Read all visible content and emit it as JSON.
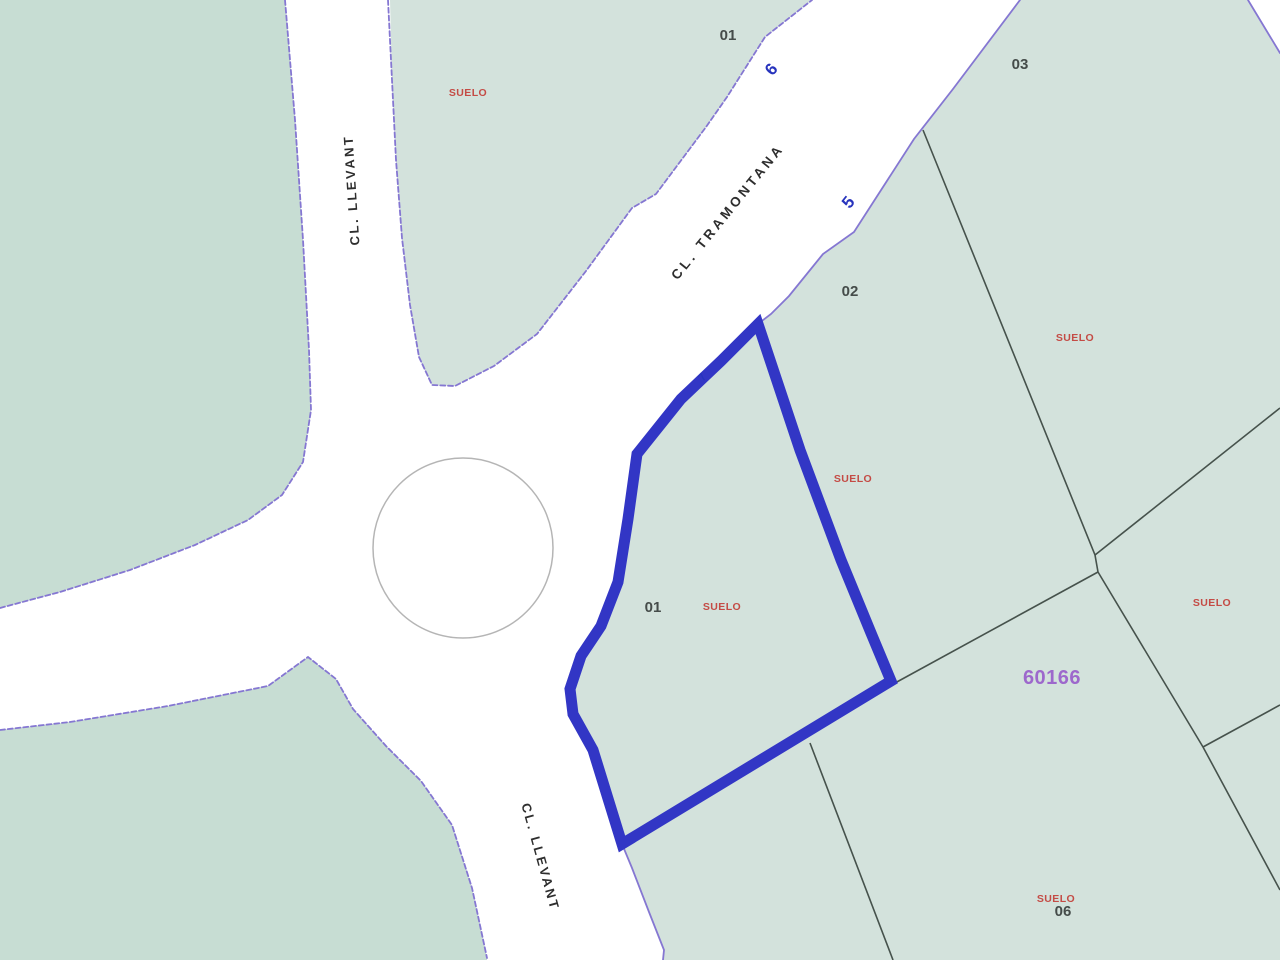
{
  "map": {
    "title": "Cadastral parcel map",
    "block_reference": "60166",
    "streets": [
      {
        "name": "CL. LLEVANT",
        "position": "top-left",
        "direction": "vertical"
      },
      {
        "name": "CL. TRAMONTANA",
        "position": "upper-center",
        "direction": "diagonal"
      },
      {
        "name": "CL. LLEVANT",
        "position": "bottom-center",
        "direction": "diagonal"
      }
    ],
    "street_numbers": [
      {
        "value": "6"
      },
      {
        "value": "5"
      },
      {
        "value": "7"
      }
    ],
    "parcel_numbers": [
      {
        "value": "01",
        "area": "top-center-parcel"
      },
      {
        "value": "03",
        "area": "top-right-parcel"
      },
      {
        "value": "02",
        "area": "center-right-parcel"
      },
      {
        "value": "01",
        "area": "highlighted-parcel"
      },
      {
        "value": "06",
        "area": "bottom-right-parcel"
      }
    ],
    "land_use_labels": [
      {
        "text": "SUELO",
        "area": "top-left-parcel"
      },
      {
        "text": "SUELO",
        "area": "parcel-03"
      },
      {
        "text": "SUELO",
        "area": "parcel-02"
      },
      {
        "text": "SUELO",
        "area": "highlighted-parcel"
      },
      {
        "text": "SUELO",
        "area": "right-edge-parcel"
      },
      {
        "text": "SUELO",
        "area": "parcel-06"
      }
    ],
    "colors": {
      "parcel_fill_left": "#c7ddd3",
      "parcel_fill_right": "#d3e2dc",
      "road_fill": "#ffffff",
      "road_edge": "#8577d2",
      "parcel_boundary": "#46524c",
      "highlight_outline": "#3236c5",
      "suelo_text": "#c44b45",
      "block_reference_text": "#9d68cc",
      "street_number_text": "#2733bd",
      "parcel_number_text": "#454c4a",
      "street_name_text": "#2e2e2e",
      "roundabout_stroke": "#b5b5b5"
    }
  }
}
